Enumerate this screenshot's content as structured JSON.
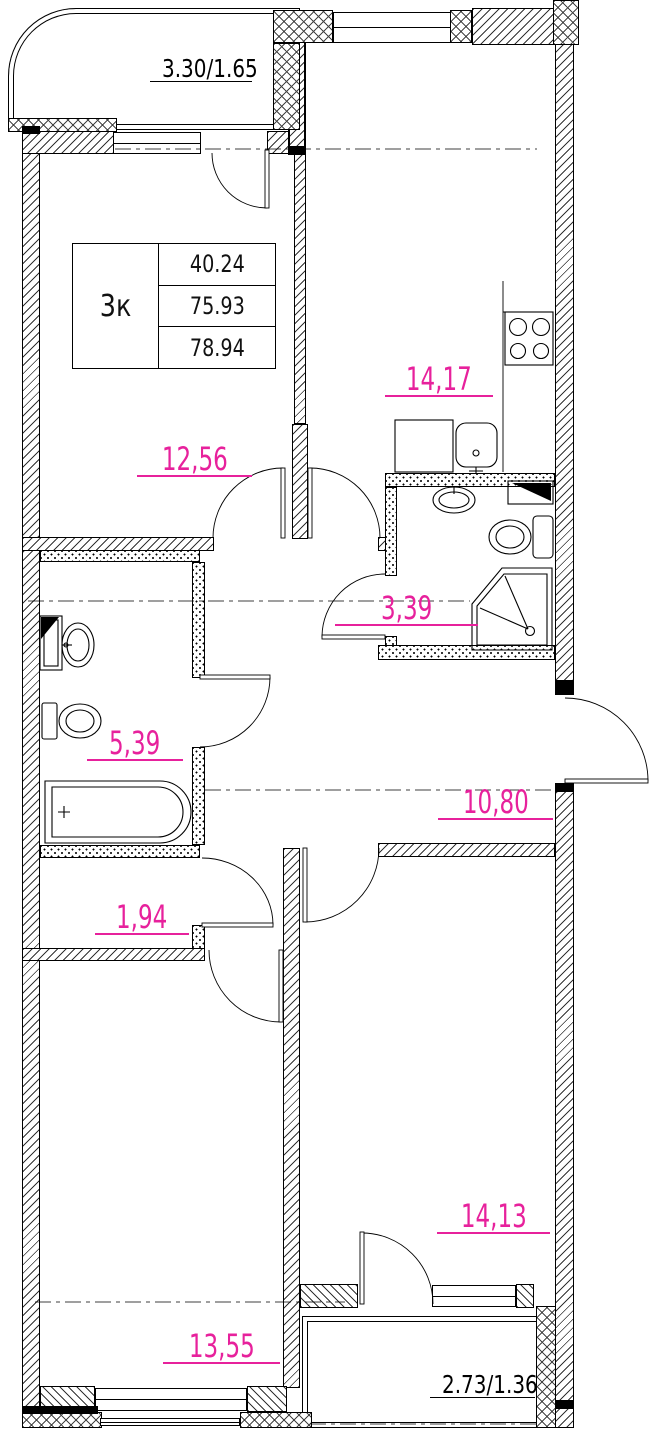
{
  "unit_table": {
    "type_label": "3к",
    "area_living": "40.24",
    "area_main": "75.93",
    "area_total": "78.94"
  },
  "areas": {
    "balcony_top": "3.30/1.65",
    "kitchen": "14,17",
    "living": "12,56",
    "bathroom": "3,39",
    "wc": "5,39",
    "hall": "10,80",
    "closet": "1,94",
    "bedroom_left": "13,55",
    "bedroom_right": "14,13",
    "balcony_bottom": "2.73/1.36"
  },
  "colors": {
    "area_label": "#e7219c",
    "ink": "#111111"
  },
  "icons": [
    "stove-icon",
    "kitchen-sink-icon",
    "cabinet-icon",
    "bath-sink-icon",
    "toilet-icon",
    "shower-tray-icon",
    "vent-shaft-icon",
    "wc-sink-icon",
    "wc-toilet-icon",
    "bathtub-icon"
  ]
}
